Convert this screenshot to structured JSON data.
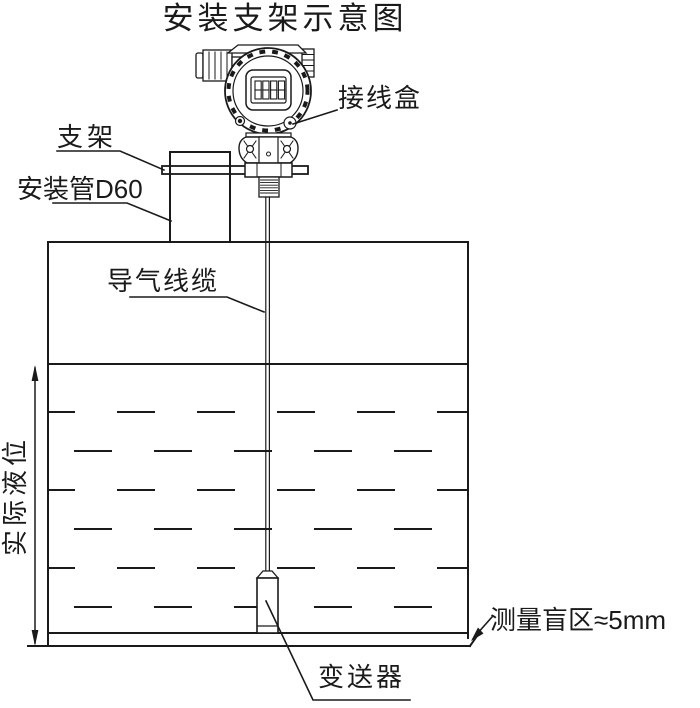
{
  "title": "安装支架示意图",
  "labels": {
    "junction_box": "接线盒",
    "bracket": "支架",
    "mounting_pipe": "安装管D60",
    "air_cable": "导气线缆",
    "actual_level": "实际液位",
    "blind_zone": "测量盲区≈5mm",
    "transmitter": "变送器"
  },
  "device": {
    "display_reading": "8888"
  },
  "colors": {
    "line": "#1a1a1a",
    "background": "#ffffff"
  }
}
